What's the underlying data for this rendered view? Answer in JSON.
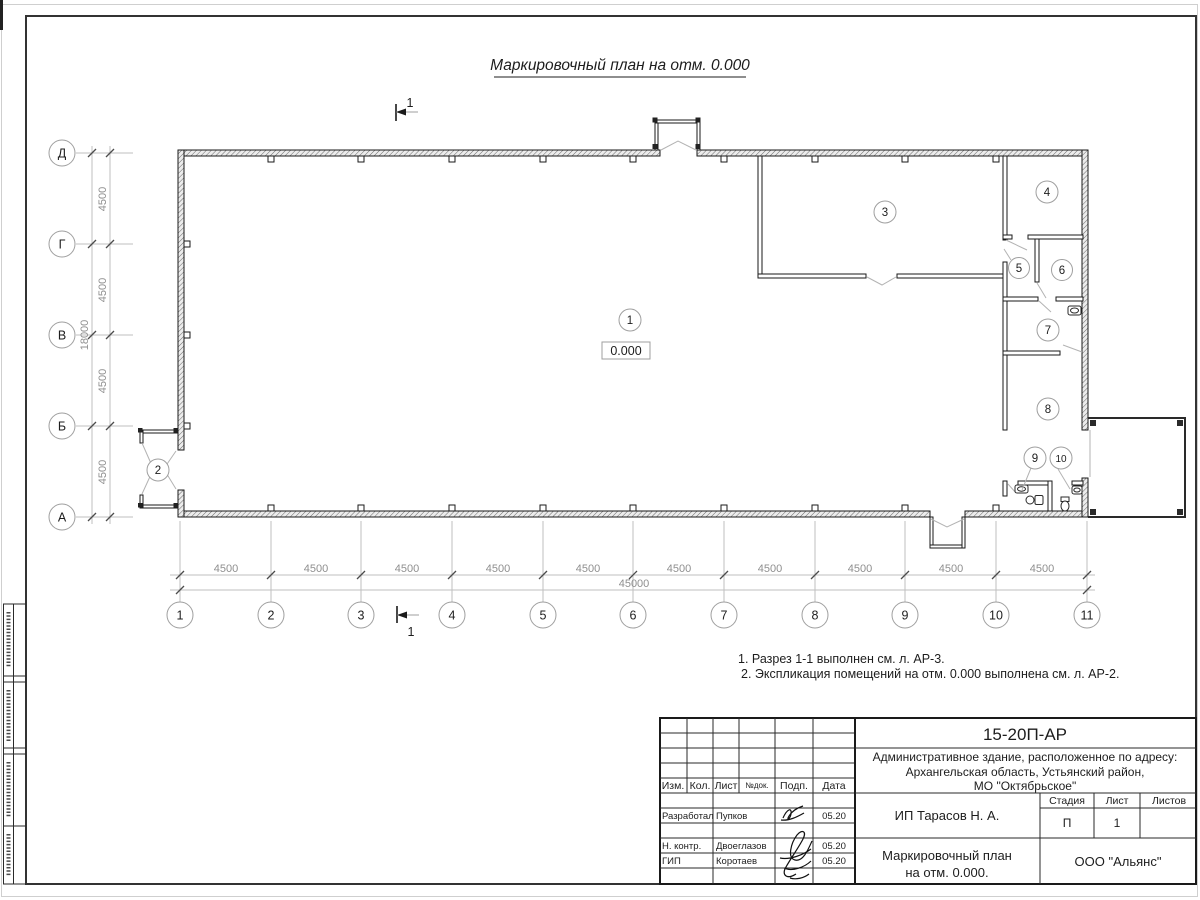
{
  "drawing": {
    "title": "Маркировочный план на отм. 0.000",
    "elevation": "0.000",
    "section": "1",
    "notes": [
      "1. Разрез 1-1 выполнен см. л. АР-3.",
      "2. Экспликация помещений на отм. 0.000 выполнена см. л. АР-2."
    ]
  },
  "axes": {
    "vertical": {
      "labels": [
        "Д",
        "Г",
        "В",
        "Б",
        "А"
      ],
      "segment_dim": "4500",
      "total_dim": "18000"
    },
    "horizontal": {
      "labels": [
        "1",
        "2",
        "3",
        "4",
        "5",
        "6",
        "7",
        "8",
        "9",
        "10",
        "11"
      ],
      "segment_dim": "4500",
      "total_dim": "45000"
    }
  },
  "rooms": [
    "1",
    "2",
    "3",
    "4",
    "5",
    "6",
    "7",
    "8",
    "9",
    "10"
  ],
  "title_block": {
    "doc_number": "15-20П-АР",
    "object_line1": "Административное здание, расположенное по адресу:",
    "object_line2": "Архангельская область, Устьянский район,",
    "object_line3": "МО \"Октябрьское\"",
    "cols": {
      "izm": "Изм.",
      "kol": "Кол.",
      "list": "Лист",
      "doc": "№док.",
      "podp": "Подп.",
      "date": "Дата"
    },
    "rows": [
      {
        "role": "Разработал",
        "name": "Пупков",
        "date": "05.20"
      },
      {
        "role": "Н. контр.",
        "name": "Двоеглазов",
        "date": "05.20"
      },
      {
        "role": "ГИП",
        "name": "Коротаев",
        "date": "05.20"
      }
    ],
    "client": "ИП Тарасов Н. А.",
    "stage_label": "Стадия",
    "sheet_label": "Лист",
    "sheets_label": "Листов",
    "stage": "П",
    "sheet_number": "1",
    "sheet_name_line1": "Маркировочный план",
    "sheet_name_line2": "на отм. 0.000.",
    "company": "ООО \"Альянс\""
  }
}
